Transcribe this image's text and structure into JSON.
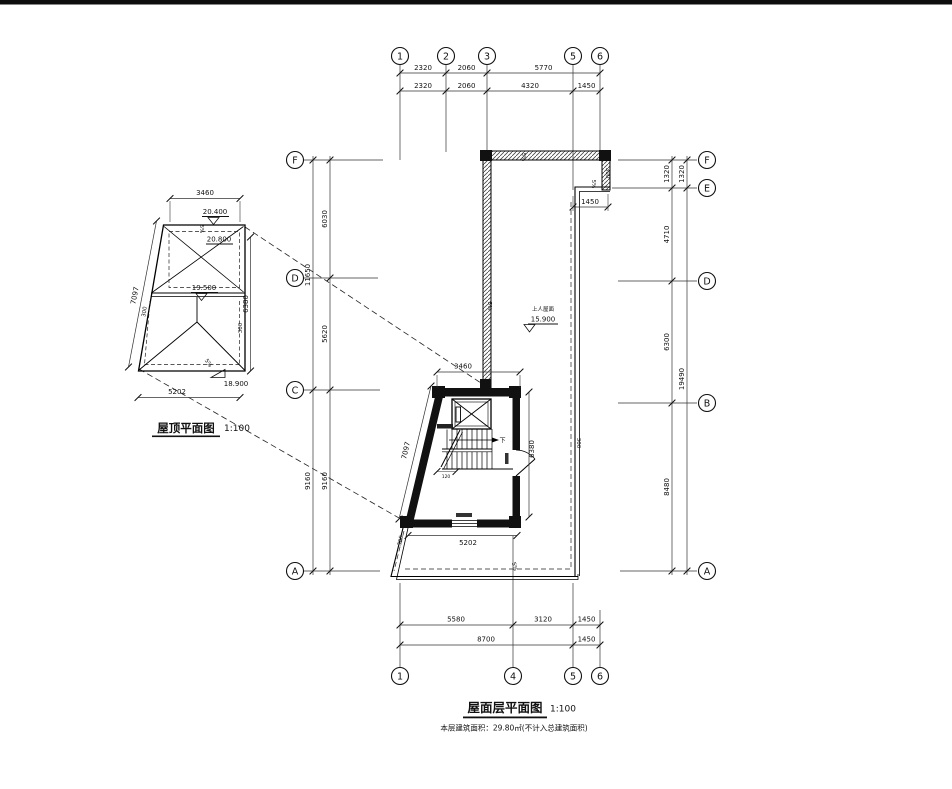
{
  "axis": {
    "top": [
      "1",
      "2",
      "3",
      "5",
      "6"
    ],
    "bottom": [
      "1",
      "4",
      "5",
      "6"
    ],
    "left": [
      "F",
      "D",
      "C",
      "A"
    ],
    "right": [
      "F",
      "E",
      "D",
      "B",
      "A"
    ]
  },
  "dims": {
    "top1": [
      "2320",
      "2060",
      "5770"
    ],
    "top2": [
      "2320",
      "2060",
      "4320",
      "1450"
    ],
    "bottom1": [
      "5580",
      "3120",
      "1450"
    ],
    "bottom2": [
      "8700",
      "1450"
    ],
    "left_inner": [
      "6030",
      "5620",
      "9160"
    ],
    "left_outer": [
      "11650",
      "9160"
    ],
    "right_inner": [
      "1320",
      "4710",
      "6300",
      "8480"
    ],
    "right_outer": [
      "1320",
      "19490"
    ],
    "step": "1450",
    "core_top": "3460",
    "core_bottom": "5202",
    "core_right": "6380",
    "core_slant": "7097",
    "stair_width": "120",
    "offset": "300"
  },
  "roof_plan": {
    "title": "屋顶平面图",
    "scale": "1:100",
    "dim_top": "3460",
    "dim_bottom": "5202",
    "dim_right": "6380",
    "dim_slant": "7097",
    "level_ridge": "20.400",
    "level_ridge2": "20.800",
    "level_mid": "19.500",
    "level_eave": "18.900",
    "slope": "5%",
    "offset": "300"
  },
  "main_plan": {
    "roof_area_label": "上人屋面",
    "roof_area_level": "15.900",
    "stair_down": "下",
    "slope": "5%",
    "title": "屋面层平面图",
    "scale": "1:100",
    "note": "本层建筑面积：29.80㎡(不计入总建筑面积)"
  }
}
